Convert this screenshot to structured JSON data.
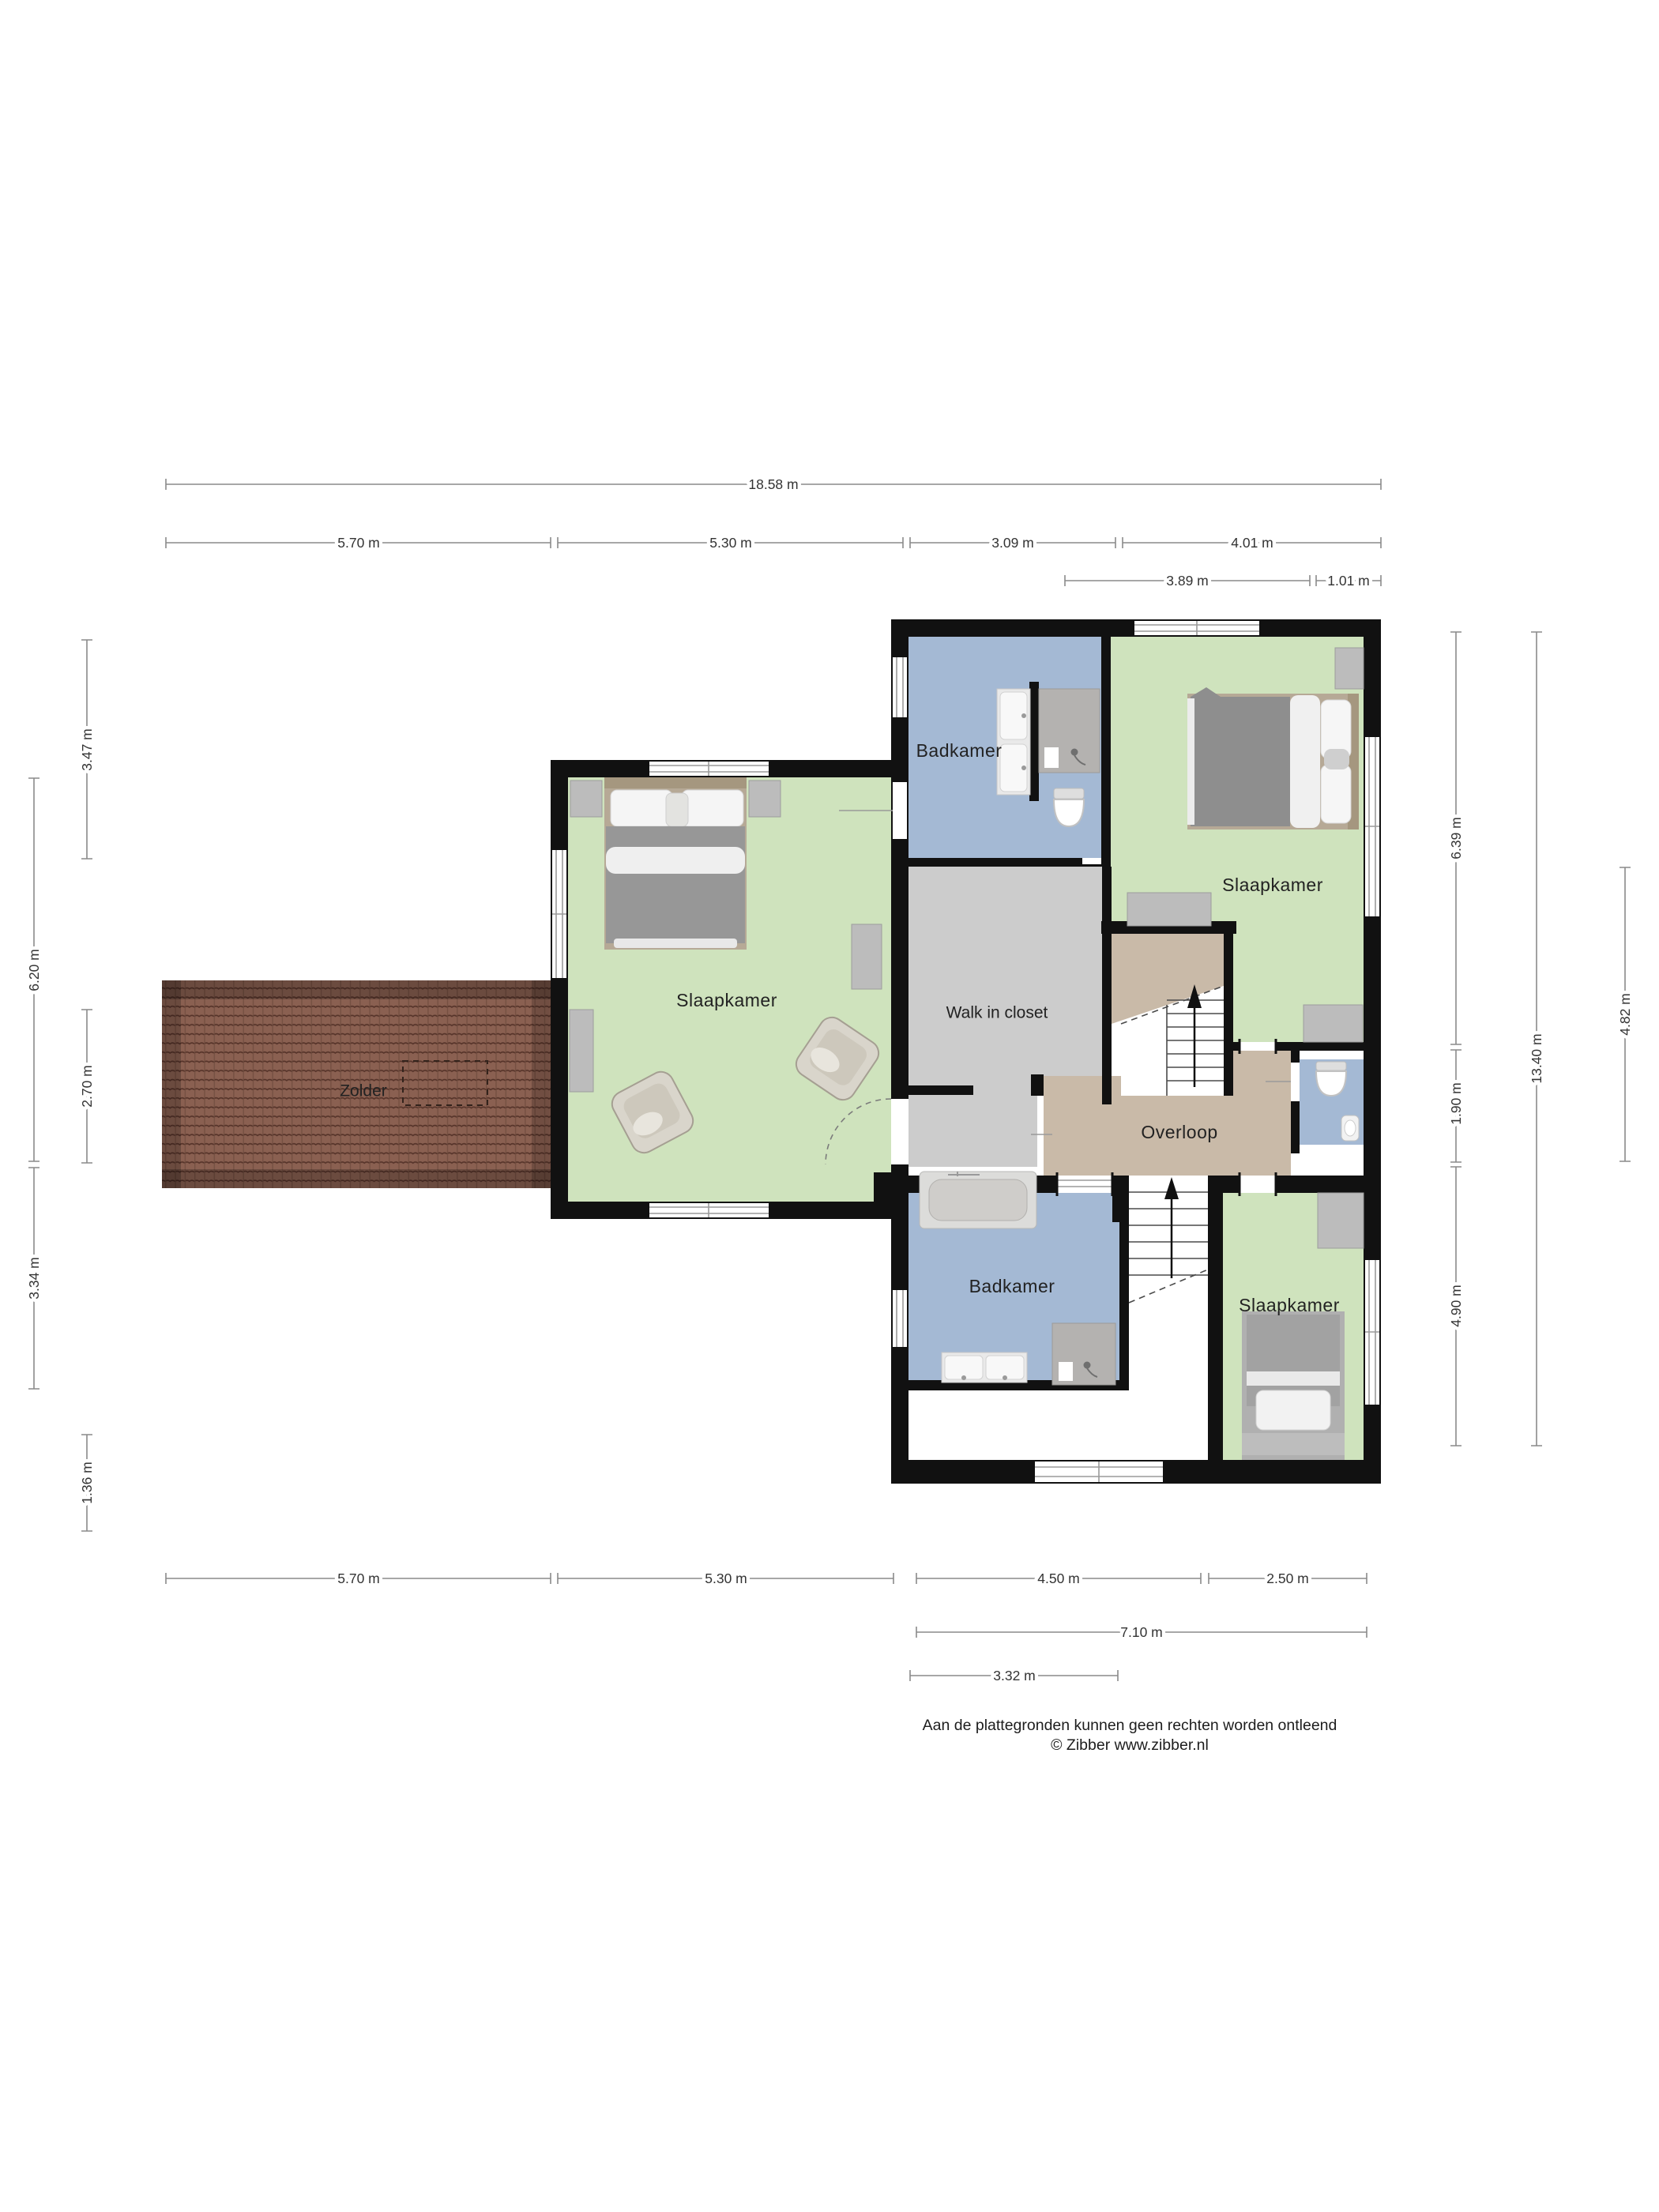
{
  "document_type": "floorplan",
  "footer": {
    "line1": "Aan de plattegronden kunnen geen rechten worden ontleend",
    "line2": "© Zibber www.zibber.nl"
  },
  "rooms": [
    {
      "id": "badkamer-top",
      "label": "Badkamer"
    },
    {
      "id": "slaapkamer-top",
      "label": "Slaapkamer"
    },
    {
      "id": "slaapkamer-left",
      "label": "Slaapkamer"
    },
    {
      "id": "walk-in-closet",
      "label": "Walk in closet"
    },
    {
      "id": "zolder",
      "label": "Zolder"
    },
    {
      "id": "overloop",
      "label": "Overloop"
    },
    {
      "id": "badkamer-bottom",
      "label": "Badkamer"
    },
    {
      "id": "slaapkamer-bottom",
      "label": "Slaapkamer"
    }
  ],
  "dimensions": {
    "top": [
      "18.58 m",
      "5.70 m",
      "5.30 m",
      "3.09 m",
      "4.01 m",
      "3.89 m",
      "1.01 m"
    ],
    "bottom": [
      "5.70 m",
      "5.30 m",
      "4.50 m",
      "2.50 m",
      "7.10 m",
      "3.32 m"
    ],
    "left": [
      "3.47 m",
      "6.20 m",
      "2.70 m",
      "3.34 m",
      "1.36 m"
    ],
    "right": [
      "6.39 m",
      "1.90 m",
      "4.90 m",
      "13.40 m",
      "4.82 m"
    ]
  },
  "symbols": {
    "stairs_up_arrow": "▲",
    "skylight_dashed_rect": "dashed outline on roof",
    "fixtures": [
      "bathtub",
      "double-sink-vanity",
      "shower",
      "toilet",
      "wash-basin",
      "double-bed",
      "single-bed",
      "armchair",
      "cabinet"
    ]
  },
  "colors": {
    "room_green": "#cfe3bd",
    "room_blue": "#a4b9d4",
    "room_gray": "#cccccc",
    "room_tan": "#c9baa8",
    "wall": "#111111",
    "roof_tiles": "#8a6051",
    "dim_line": "#8a8a8a",
    "text": "#222222"
  }
}
